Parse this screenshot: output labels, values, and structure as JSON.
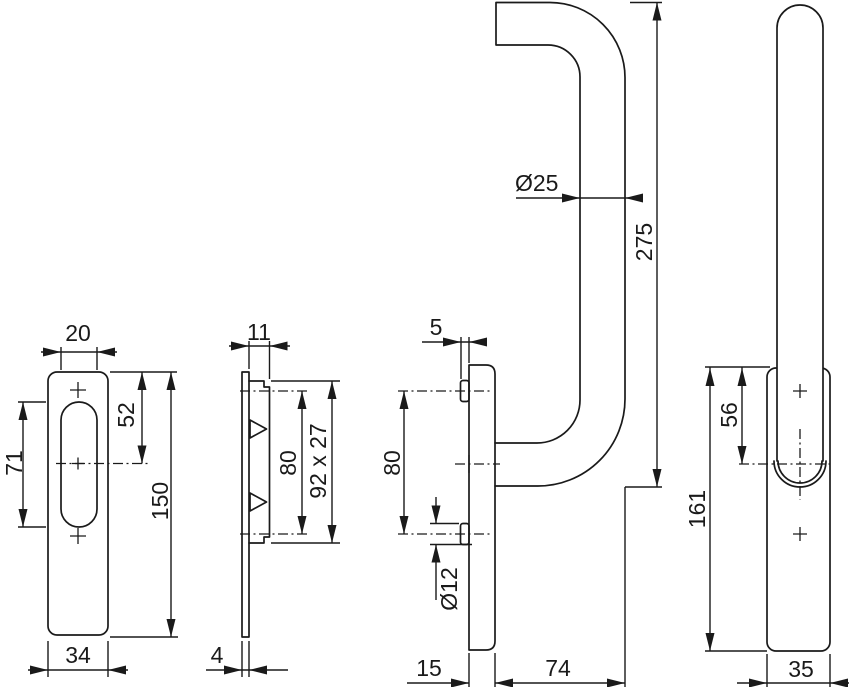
{
  "drawing": {
    "description": "Technical dimension drawing of a lift-slide door pull handle set: backplate front view, backplate side view, handle side view, handle front view",
    "background_color": "#ffffff",
    "line_color": "#1a1a1a",
    "views": {
      "plate_front": {
        "name": "backplate front view",
        "dims": {
          "slot_width": "20",
          "slot_height": "71",
          "top_to_center": "52",
          "plate_height": "150",
          "plate_width": "34"
        }
      },
      "plate_side": {
        "name": "backplate side view",
        "dims": {
          "boss_depth": "11",
          "hole_spacing": "80",
          "boss_face": "92 x 27",
          "plate_thickness": "4"
        }
      },
      "handle_side": {
        "name": "handle side view",
        "dims": {
          "pin_protrusion": "5",
          "hole_spacing": "80",
          "pin_diameter": "Ø12",
          "plate_depth": "15",
          "projection": "74",
          "tube_diameter": "Ø25",
          "grip_length": "275"
        }
      },
      "handle_front": {
        "name": "handle front view",
        "dims": {
          "top_to_center": "56",
          "plate_height": "161",
          "plate_width": "35"
        }
      }
    }
  }
}
